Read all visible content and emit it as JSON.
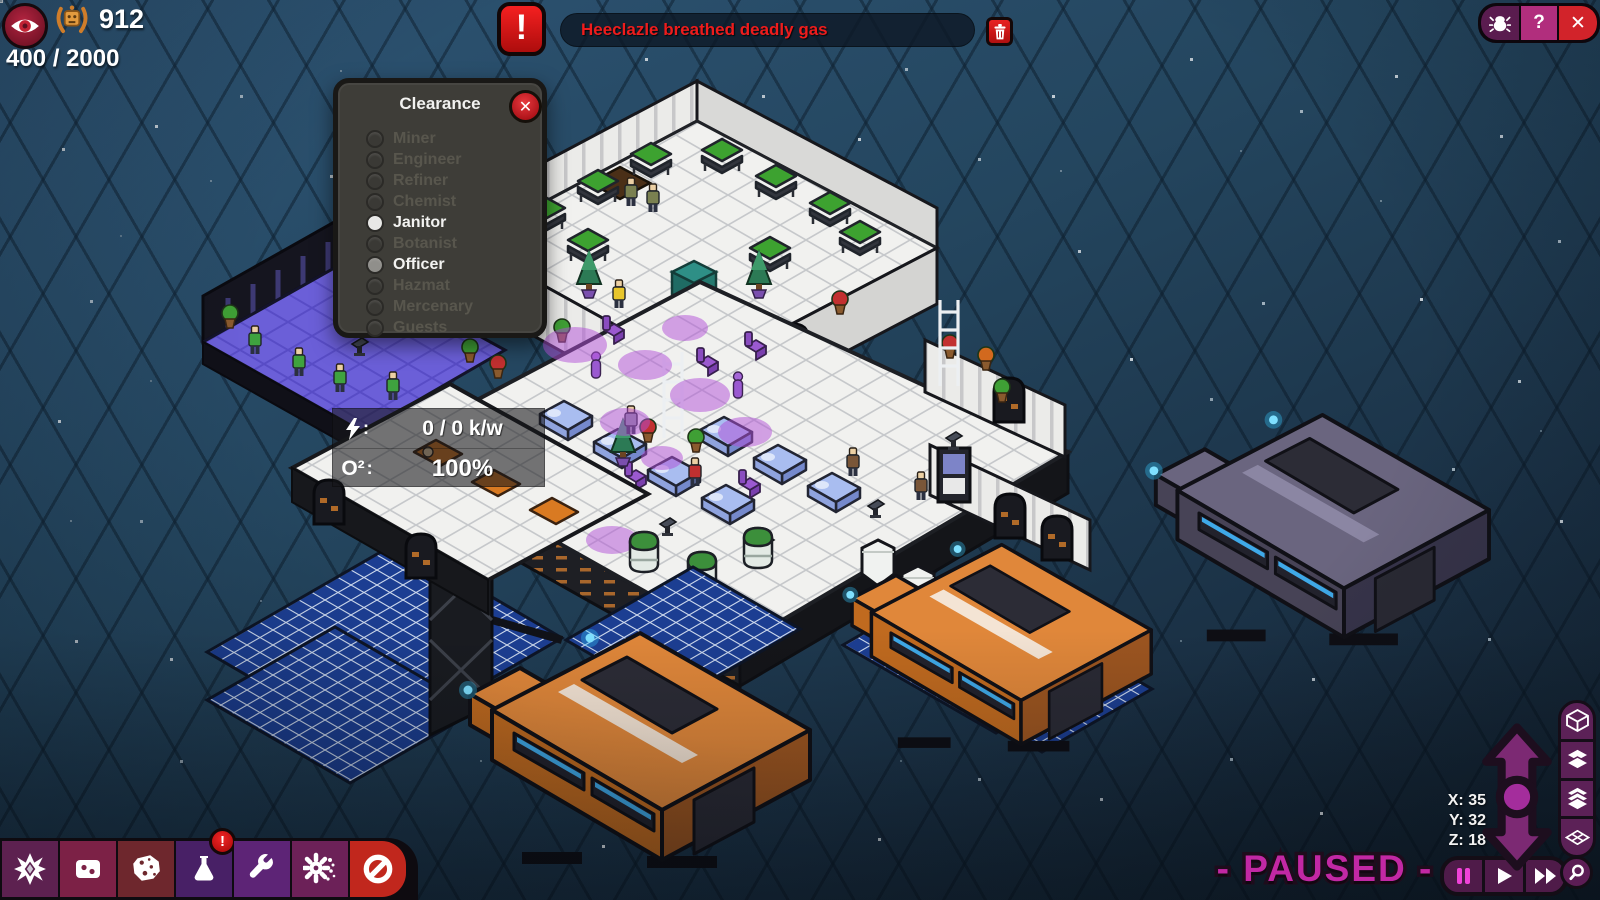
{
  "hud": {
    "score_badge": "912",
    "capacity": "400 / 2000",
    "alert": {
      "message": "Heeclazle breathed deadly gas",
      "icon": "exclamation-icon",
      "dismiss_icon": "trash-icon"
    },
    "top_right": {
      "bug_icon": "bug-report",
      "help_label": "?",
      "close_label": "✕"
    },
    "eye_icon": "visibility-eye",
    "medal_icon": "merit-laurel"
  },
  "clearance": {
    "title": "Clearance",
    "close_label": "✕",
    "items": [
      {
        "label": "Miner",
        "state": "disabled"
      },
      {
        "label": "Engineer",
        "state": "disabled"
      },
      {
        "label": "Refiner",
        "state": "disabled"
      },
      {
        "label": "Chemist",
        "state": "disabled"
      },
      {
        "label": "Janitor",
        "state": "selected"
      },
      {
        "label": "Botanist",
        "state": "disabled"
      },
      {
        "label": "Officer",
        "state": "active"
      },
      {
        "label": "Hazmat",
        "state": "disabled"
      },
      {
        "label": "Mercenary",
        "state": "disabled"
      },
      {
        "label": "Guests",
        "state": "disabled"
      }
    ]
  },
  "status_tooltip": {
    "power_icon": "lightning-bolt",
    "power_colon": ":",
    "power_value": "0 / 0 k/w",
    "oxygen_label": "O²",
    "oxygen_colon": ":",
    "oxygen_value": "100%"
  },
  "toolbar": {
    "buttons": [
      {
        "icon": "compass-star"
      },
      {
        "icon": "room-tile"
      },
      {
        "icon": "asteroid"
      },
      {
        "icon": "flask",
        "badge": "!"
      },
      {
        "icon": "wrench"
      },
      {
        "icon": "gear-splat"
      },
      {
        "icon": "forbidden"
      }
    ]
  },
  "playback": {
    "paused_label": "- PAUSED -",
    "buttons": [
      "pause",
      "play",
      "fast-forward"
    ],
    "search_icon": "magnifier"
  },
  "coords": {
    "x": "X: 35",
    "y": "Y: 32",
    "z": "Z: 18"
  },
  "view_controls": {
    "buttons": [
      "cube-wireframe",
      "layers-filled",
      "layers-stack",
      "layer-wireframe"
    ]
  },
  "colors": {
    "accent_magenta": "#c228a4",
    "panel_purple": "#5c2157",
    "alert_red": "#ee1c1c",
    "button_red": "#c1271d",
    "solar_blue": "#1c3e92",
    "hull_orange": "#e0873a",
    "hull_slate": "#6a657f"
  }
}
